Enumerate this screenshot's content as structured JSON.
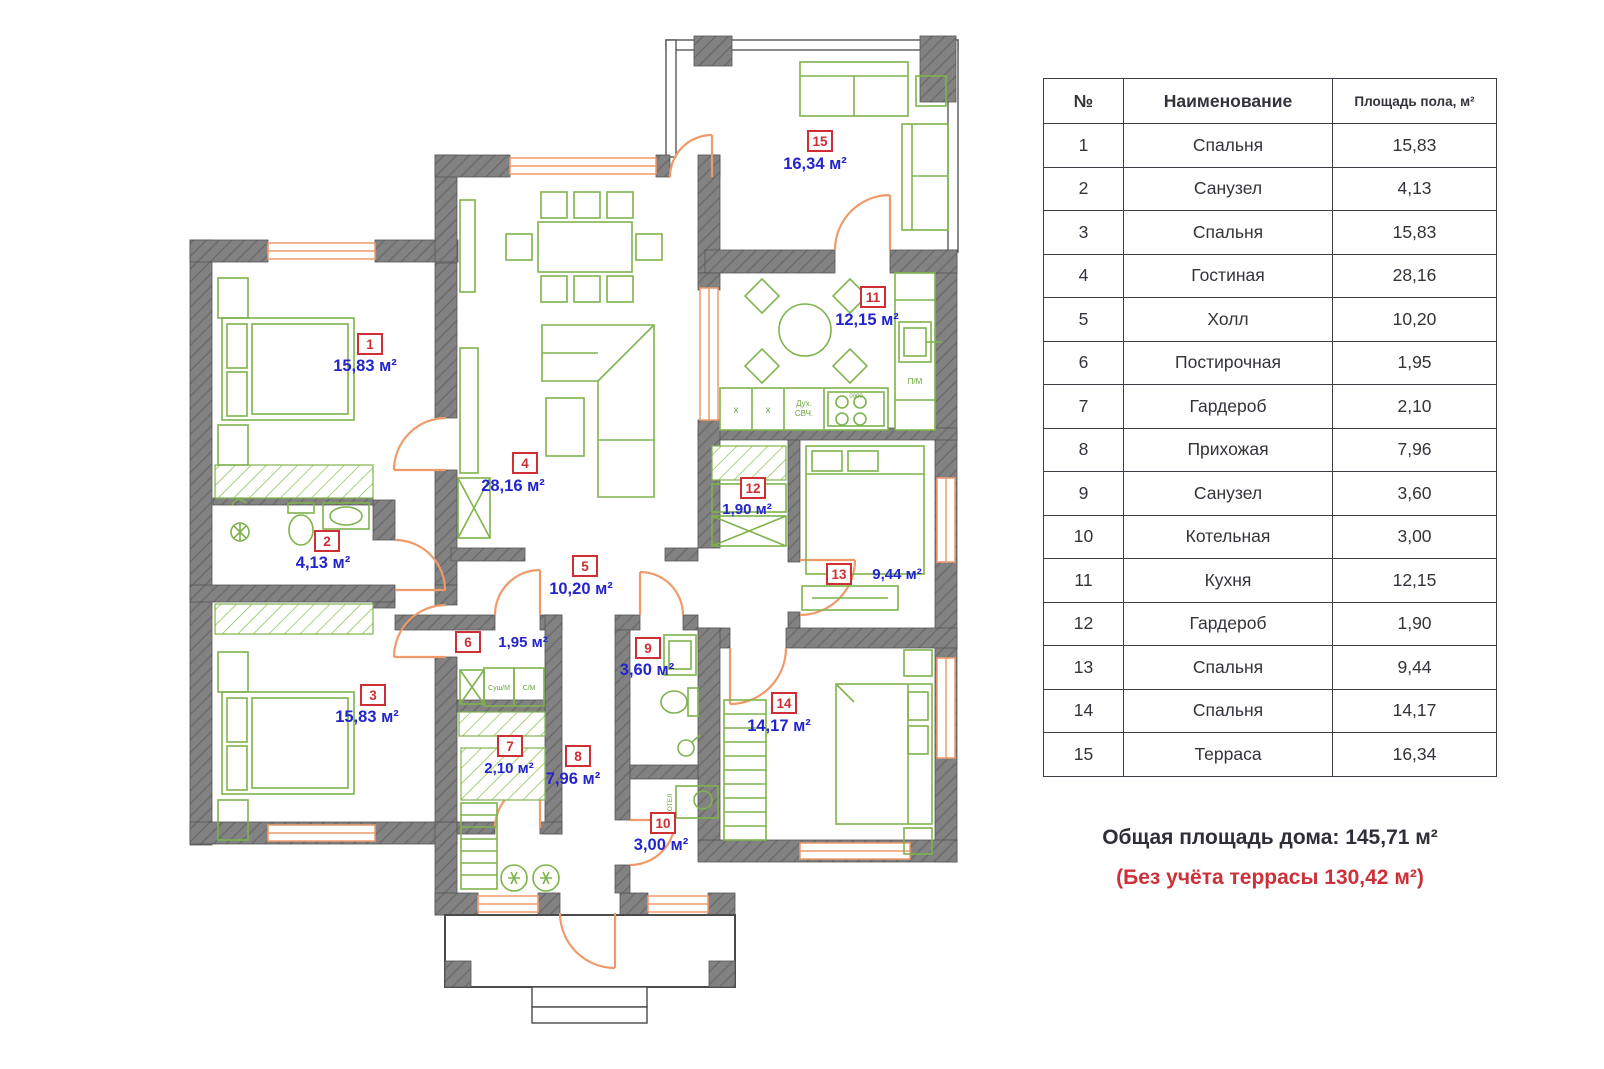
{
  "plan": {
    "rooms": [
      {
        "num": "1",
        "area": "15,83 м²"
      },
      {
        "num": "2",
        "area": "4,13 м²"
      },
      {
        "num": "3",
        "area": "15,83 м²"
      },
      {
        "num": "4",
        "area": "28,16 м²"
      },
      {
        "num": "5",
        "area": "10,20 м²"
      },
      {
        "num": "6",
        "area": "1,95 м²"
      },
      {
        "num": "7",
        "area": "2,10 м²"
      },
      {
        "num": "8",
        "area": "7,96 м²"
      },
      {
        "num": "9",
        "area": "3,60 м²"
      },
      {
        "num": "10",
        "area": "3,00 м²"
      },
      {
        "num": "11",
        "area": "12,15 м²"
      },
      {
        "num": "12",
        "area": "1,90 м²"
      },
      {
        "num": "13",
        "area": "9,44 м²"
      },
      {
        "num": "14",
        "area": "14,17 м²"
      },
      {
        "num": "15",
        "area": "16,34 м²"
      }
    ],
    "small": {
      "washer_dryer": "Суш/М",
      "washing_machine": "С/М",
      "oven": "Дух.",
      "microwave": "СВЧ.",
      "dishwasher": "П/М",
      "boiler": "КОТЕЛ",
      "cabinet_x1": "x",
      "cabinet_x2": "x",
      "burner_display": "0000"
    }
  },
  "table": {
    "headers": {
      "num": "№",
      "name": "Наименование",
      "area": "Площадь пола, м²"
    },
    "rows": [
      {
        "num": "1",
        "name": "Спальня",
        "area": "15,83"
      },
      {
        "num": "2",
        "name": "Санузел",
        "area": "4,13"
      },
      {
        "num": "3",
        "name": "Спальня",
        "area": "15,83"
      },
      {
        "num": "4",
        "name": "Гостиная",
        "area": "28,16"
      },
      {
        "num": "5",
        "name": "Холл",
        "area": "10,20"
      },
      {
        "num": "6",
        "name": "Постирочная",
        "area": "1,95"
      },
      {
        "num": "7",
        "name": "Гардероб",
        "area": "2,10"
      },
      {
        "num": "8",
        "name": "Прихожая",
        "area": "7,96"
      },
      {
        "num": "9",
        "name": "Санузел",
        "area": "3,60"
      },
      {
        "num": "10",
        "name": "Котельная",
        "area": "3,00"
      },
      {
        "num": "11",
        "name": "Кухня",
        "area": "12,15"
      },
      {
        "num": "12",
        "name": "Гардероб",
        "area": "1,90"
      },
      {
        "num": "13",
        "name": "Спальня",
        "area": "9,44"
      },
      {
        "num": "14",
        "name": "Спальня",
        "area": "14,17"
      },
      {
        "num": "15",
        "name": "Терраса",
        "area": "16,34"
      }
    ]
  },
  "totals": {
    "total": "Общая площадь дома: 145,71 м²",
    "note": "(Без учёта террасы 130,42 м²)"
  },
  "colors": {
    "accent_red": "#cf2e35",
    "label_blue": "#2424ce",
    "furniture_green": "#7fb34c",
    "opening_orange": "#ef9a6a",
    "wall_gray": "#7f7f7f"
  }
}
